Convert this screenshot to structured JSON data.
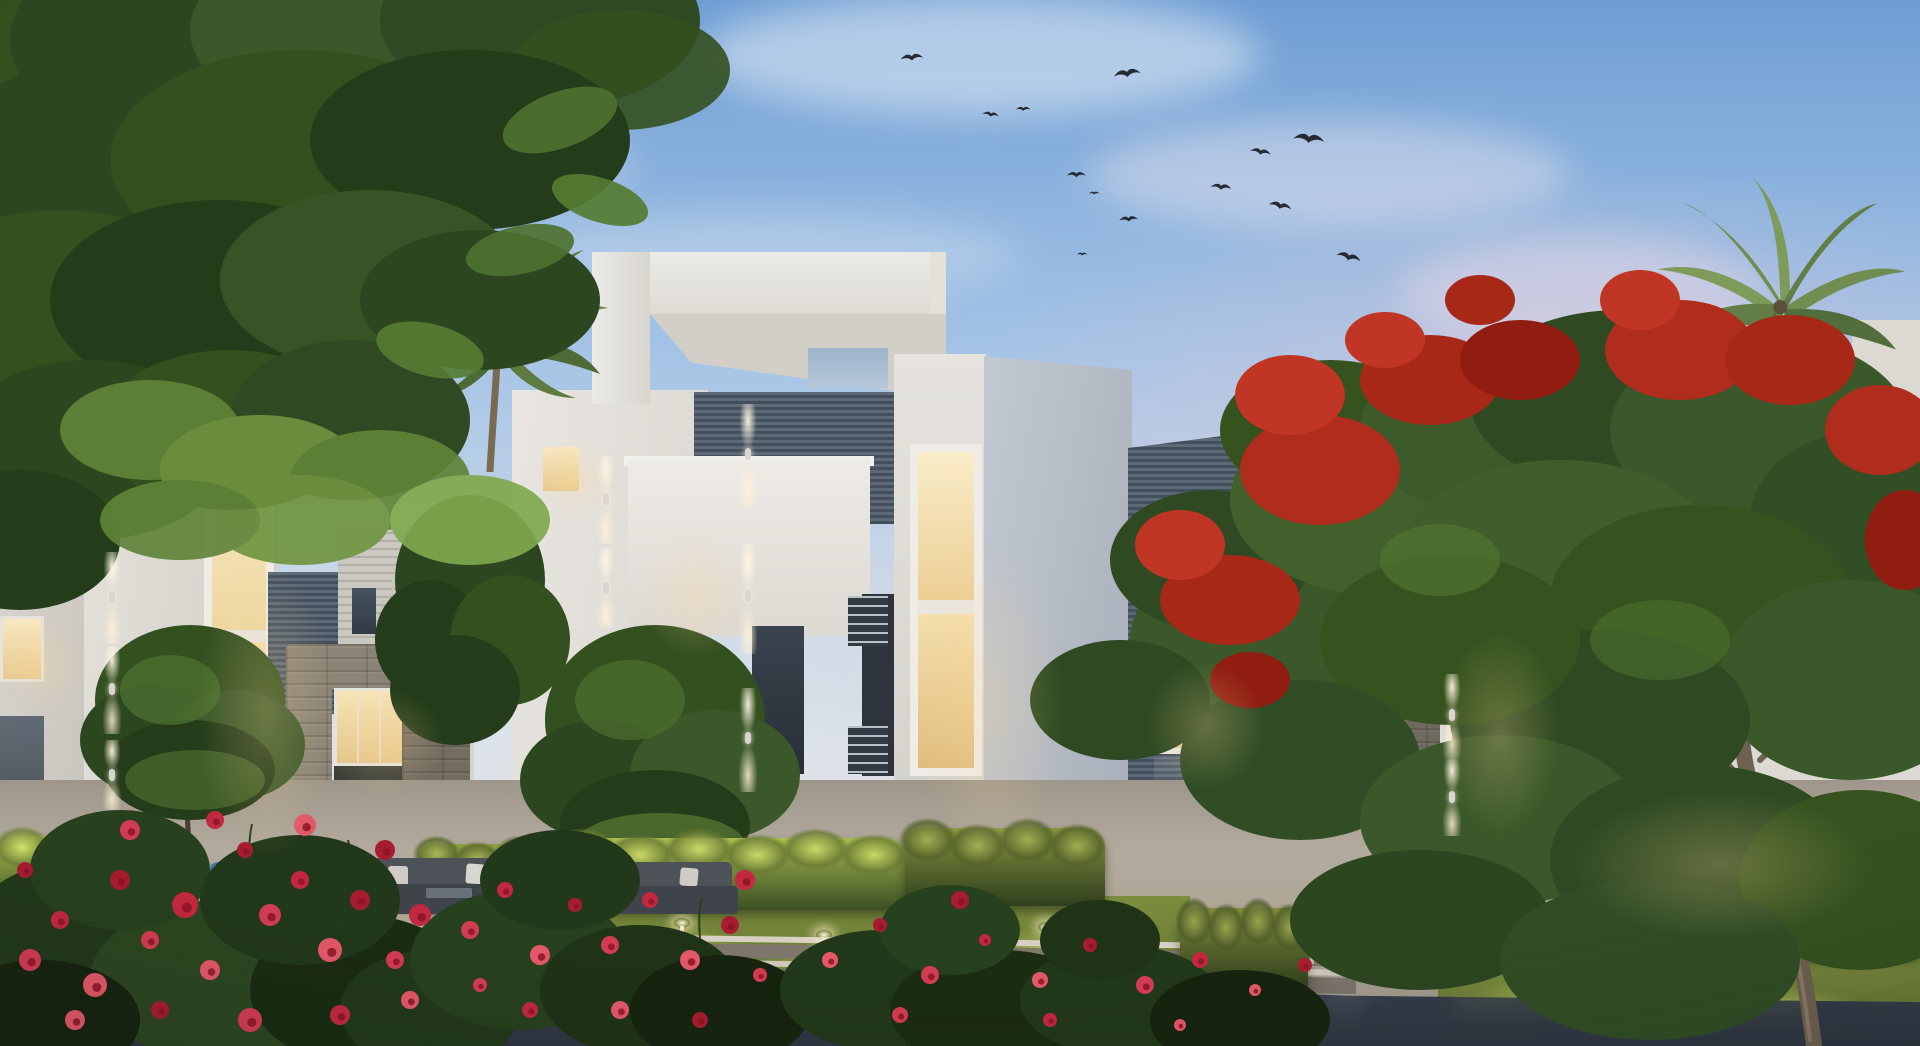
{
  "meta": {
    "scene": "Dusk architectural rendering — modern white residential villas with lit windows, palms, flame tree, rose beds, lit hedges and a reflective promenade",
    "width": 1920,
    "height": 1046,
    "time_of_day": "dusk",
    "visible_text": "none"
  },
  "palette": {
    "sky-top": "#6f9ed4",
    "sky-mid": "#a5c4e6",
    "sky-low": "#cfdbe9",
    "sky-pink": "#dec4d6",
    "cloud": "#eef3f8",
    "bird": "#262b33",
    "wall-white": "#e7e4df",
    "wall-shade": "#d2cfc9",
    "wall-blue": "#b7bdc7",
    "louver-light": "#5c6a78",
    "louver-dark": "#434f5c",
    "siding": "#c9c6c0",
    "siding-line": "#aeaba5",
    "stone": "#8b8476",
    "stone-dark": "#6e685c",
    "glow-warm": "#f5e2b4",
    "glow-deep": "#e9cf98",
    "hedge-lit": "#b9cb54",
    "hedge-dark": "#3f5226",
    "lawn": "#84953f",
    "lawn-lit": "#ccd76a",
    "foliage-dark": "#2c4620",
    "foliage-mid": "#33501f",
    "foliage-light": "#557c33",
    "palm-green": "#6f8c4c",
    "flame-red": "#b02c1c",
    "rose-red": "#d23c52",
    "pavement": "#aca394",
    "pavement-dark": "#8f887c",
    "water": "#3e4654",
    "trunk": "#5a4a34",
    "accent-chair": "#3f7fb5"
  },
  "sky": {
    "clouds": [
      {
        "x": 980,
        "y": 55,
        "w": 560,
        "h": 120,
        "o": 0.5,
        "c": "#eef3f8"
      },
      {
        "x": 420,
        "y": 165,
        "w": 420,
        "h": 95,
        "o": 0.38,
        "c": "#eef3f8"
      },
      {
        "x": 170,
        "y": 300,
        "w": 340,
        "h": 70,
        "o": 0.32,
        "c": "#e8eef5"
      },
      {
        "x": 1330,
        "y": 175,
        "w": 480,
        "h": 110,
        "o": 0.42,
        "c": "#f0e8ee"
      },
      {
        "x": 760,
        "y": 255,
        "w": 520,
        "h": 85,
        "o": 0.3,
        "c": "#eaf0f6"
      },
      {
        "x": 1580,
        "y": 295,
        "w": 360,
        "h": 120,
        "o": 0.45,
        "c": "#efe0e8"
      }
    ],
    "birds": [
      {
        "x": 900,
        "y": 54,
        "s": 1.1,
        "r": -5
      },
      {
        "x": 983,
        "y": 110,
        "s": 0.8,
        "r": 8
      },
      {
        "x": 1016,
        "y": 106,
        "s": 0.7,
        "r": 0
      },
      {
        "x": 1113,
        "y": 70,
        "s": 1.3,
        "r": -8
      },
      {
        "x": 1294,
        "y": 131,
        "s": 1.5,
        "r": 6
      },
      {
        "x": 1251,
        "y": 146,
        "s": 1.0,
        "r": 10
      },
      {
        "x": 1067,
        "y": 171,
        "s": 0.9,
        "r": 0
      },
      {
        "x": 1089,
        "y": 191,
        "s": 0.5,
        "r": 0
      },
      {
        "x": 1119,
        "y": 216,
        "s": 0.9,
        "r": -4
      },
      {
        "x": 1211,
        "y": 182,
        "s": 1.0,
        "r": 5
      },
      {
        "x": 1270,
        "y": 199,
        "s": 1.1,
        "r": 12
      },
      {
        "x": 1077,
        "y": 252,
        "s": 0.5,
        "r": 0
      },
      {
        "x": 1338,
        "y": 249,
        "s": 1.2,
        "r": 15
      }
    ]
  },
  "buildings": {
    "far_left_block": {
      "color": "white",
      "lit_windows": 1,
      "dim_windows": 1
    },
    "left_villa_a": {
      "features": [
        "tall warm-lit double niche",
        "up-down wall washer lights"
      ]
    },
    "left_villa_b": {
      "features": [
        "vertical louver panel",
        "horizontal siding box",
        "two dark windows",
        "stone portal with lit interior",
        "red bougainvillea on pier"
      ]
    },
    "center_villa": {
      "features": [
        "white roof pergola frame with skylight opening",
        "recessed dark louver band",
        "balcony volume",
        "stacked warm-lit window niches",
        "wall washer columns",
        "glass storefront",
        "balcony railings"
      ]
    },
    "louver_wall": {
      "features": [
        "steel horizontal louvers",
        "warm-lit window with plant",
        "glass entry door"
      ]
    },
    "right_villa": {
      "features": [
        "horizontal siding upper box",
        "large dark corner window",
        "stone string course",
        "stone pier",
        "vertical-slat lit windows",
        "balcony slat screen",
        "large lit living-room window",
        "stone wainscot"
      ]
    },
    "far_right_sliver": {
      "color": "white"
    }
  },
  "flora": {
    "trees": [
      "overhanging canopy top-left",
      "round ornamental tree x3",
      "fan palm x2",
      "royal poinciana (flame tree)"
    ],
    "rose_flowers": [
      {
        "x": 30,
        "y": 960,
        "r": 11
      },
      {
        "x": 60,
        "y": 920,
        "r": 9
      },
      {
        "x": 95,
        "y": 985,
        "r": 12
      },
      {
        "x": 120,
        "y": 880,
        "r": 10
      },
      {
        "x": 150,
        "y": 940,
        "r": 9
      },
      {
        "x": 185,
        "y": 905,
        "r": 13
      },
      {
        "x": 210,
        "y": 970,
        "r": 10
      },
      {
        "x": 245,
        "y": 850,
        "r": 8
      },
      {
        "x": 270,
        "y": 915,
        "r": 11
      },
      {
        "x": 300,
        "y": 880,
        "r": 9
      },
      {
        "x": 330,
        "y": 950,
        "r": 12
      },
      {
        "x": 360,
        "y": 900,
        "r": 10
      },
      {
        "x": 395,
        "y": 960,
        "r": 9
      },
      {
        "x": 420,
        "y": 915,
        "r": 11
      },
      {
        "x": 75,
        "y": 1020,
        "r": 10
      },
      {
        "x": 160,
        "y": 1010,
        "r": 9
      },
      {
        "x": 250,
        "y": 1020,
        "r": 12
      },
      {
        "x": 340,
        "y": 1015,
        "r": 10
      },
      {
        "x": 410,
        "y": 1000,
        "r": 9
      },
      {
        "x": 25,
        "y": 870,
        "r": 8
      },
      {
        "x": 130,
        "y": 830,
        "r": 10
      },
      {
        "x": 215,
        "y": 820,
        "r": 9
      },
      {
        "x": 305,
        "y": 825,
        "r": 11
      },
      {
        "x": 385,
        "y": 850,
        "r": 10
      },
      {
        "x": 470,
        "y": 930,
        "r": 9
      },
      {
        "x": 505,
        "y": 890,
        "r": 8
      },
      {
        "x": 540,
        "y": 955,
        "r": 10
      },
      {
        "x": 575,
        "y": 905,
        "r": 7
      },
      {
        "x": 610,
        "y": 945,
        "r": 9
      },
      {
        "x": 650,
        "y": 900,
        "r": 8
      },
      {
        "x": 690,
        "y": 960,
        "r": 10
      },
      {
        "x": 730,
        "y": 925,
        "r": 9
      },
      {
        "x": 760,
        "y": 975,
        "r": 7
      },
      {
        "x": 530,
        "y": 1010,
        "r": 8
      },
      {
        "x": 620,
        "y": 1010,
        "r": 9
      },
      {
        "x": 700,
        "y": 1020,
        "r": 8
      },
      {
        "x": 480,
        "y": 985,
        "r": 7
      },
      {
        "x": 745,
        "y": 880,
        "r": 10
      },
      {
        "x": 830,
        "y": 960,
        "r": 8
      },
      {
        "x": 880,
        "y": 925,
        "r": 7
      },
      {
        "x": 930,
        "y": 975,
        "r": 9
      },
      {
        "x": 985,
        "y": 940,
        "r": 6
      },
      {
        "x": 1040,
        "y": 980,
        "r": 8
      },
      {
        "x": 1090,
        "y": 945,
        "r": 7
      },
      {
        "x": 1145,
        "y": 985,
        "r": 9
      },
      {
        "x": 1200,
        "y": 960,
        "r": 8
      },
      {
        "x": 1255,
        "y": 990,
        "r": 6
      },
      {
        "x": 1305,
        "y": 965,
        "r": 7
      },
      {
        "x": 900,
        "y": 1015,
        "r": 8
      },
      {
        "x": 1050,
        "y": 1020,
        "r": 7
      },
      {
        "x": 1180,
        "y": 1025,
        "r": 6
      },
      {
        "x": 960,
        "y": 900,
        "r": 9
      }
    ]
  },
  "landscape": {
    "hedges": [
      {
        "x": 0,
        "y": 836,
        "w": 198,
        "h": 74,
        "b": 1.05
      },
      {
        "x": 418,
        "y": 844,
        "w": 164,
        "h": 64,
        "b": 0.85
      },
      {
        "x": 556,
        "y": 838,
        "w": 350,
        "h": 72,
        "b": 1.0
      },
      {
        "x": 905,
        "y": 828,
        "w": 200,
        "h": 78,
        "b": 0.8
      },
      {
        "x": 1180,
        "y": 908,
        "w": 128,
        "h": 84,
        "b": 0.75
      },
      {
        "x": 1658,
        "y": 848,
        "w": 262,
        "h": 108,
        "b": 0.9
      }
    ],
    "lawn_pools": [
      {
        "x": 660,
        "y": 952,
        "rx": 95,
        "ry": 26
      },
      {
        "x": 852,
        "y": 962,
        "rx": 90,
        "ry": 24
      },
      {
        "x": 1058,
        "y": 952,
        "rx": 85,
        "ry": 24
      },
      {
        "x": 1562,
        "y": 1000,
        "rx": 95,
        "ry": 26
      },
      {
        "x": 1775,
        "y": 1010,
        "rx": 90,
        "ry": 24
      },
      {
        "x": 62,
        "y": 928,
        "rx": 70,
        "ry": 20
      },
      {
        "x": 1242,
        "y": 962,
        "rx": 70,
        "ry": 22
      }
    ],
    "bollards": [
      {
        "x": 57,
        "y": 862,
        "h": 30
      },
      {
        "x": 120,
        "y": 856,
        "h": 26
      },
      {
        "x": 680,
        "y": 926,
        "h": 30
      },
      {
        "x": 822,
        "y": 938,
        "h": 30
      },
      {
        "x": 896,
        "y": 938,
        "h": 34
      },
      {
        "x": 934,
        "y": 928,
        "h": 26
      },
      {
        "x": 963,
        "y": 938,
        "h": 28
      },
      {
        "x": 1044,
        "y": 930,
        "h": 30
      },
      {
        "x": 1310,
        "y": 934,
        "h": 30
      },
      {
        "x": 1497,
        "y": 920,
        "h": 30
      },
      {
        "x": 1592,
        "y": 938,
        "h": 32
      },
      {
        "x": 1640,
        "y": 946,
        "h": 30
      }
    ],
    "wall_washers": [
      {
        "x": 748,
        "y": 404,
        "h": 104
      },
      {
        "x": 748,
        "y": 544,
        "h": 110
      },
      {
        "x": 748,
        "y": 688,
        "h": 104
      },
      {
        "x": 606,
        "y": 456,
        "h": 88
      },
      {
        "x": 606,
        "y": 548,
        "h": 80
      },
      {
        "x": 112,
        "y": 552,
        "h": 92
      },
      {
        "x": 112,
        "y": 646,
        "h": 88
      },
      {
        "x": 112,
        "y": 740,
        "h": 70
      },
      {
        "x": 1452,
        "y": 674,
        "h": 84
      },
      {
        "x": 1452,
        "y": 758,
        "h": 78
      }
    ],
    "window_halos": [
      {
        "x": 915,
        "y": 540,
        "w": 150,
        "h": 330
      },
      {
        "x": 196,
        "y": 560,
        "w": 140,
        "h": 300
      },
      {
        "x": 640,
        "y": 530,
        "w": 110,
        "h": 130
      },
      {
        "x": 1146,
        "y": 660,
        "w": 120,
        "h": 130
      },
      {
        "x": 1440,
        "y": 630,
        "w": 120,
        "h": 210
      },
      {
        "x": 1570,
        "y": 790,
        "w": 300,
        "h": 150
      },
      {
        "x": 325,
        "y": 688,
        "w": 120,
        "h": 110
      },
      {
        "x": 536,
        "y": 440,
        "w": 80,
        "h": 80
      },
      {
        "x": 0,
        "y": 610,
        "w": 90,
        "h": 110
      }
    ],
    "reflection_streaks": [
      {
        "x": 300,
        "w": 50,
        "c": "#7a8292",
        "o": 0.25
      },
      {
        "x": 620,
        "w": 90,
        "c": "#85934e",
        "o": 0.38
      },
      {
        "x": 700,
        "w": 40,
        "c": "#9aa85c",
        "o": 0.3
      },
      {
        "x": 845,
        "w": 70,
        "c": "#85934e",
        "o": 0.35
      },
      {
        "x": 1060,
        "w": 80,
        "c": "#8b9a52",
        "o": 0.35
      },
      {
        "x": 1240,
        "w": 50,
        "c": "#7a8292",
        "o": 0.28
      },
      {
        "x": 1500,
        "w": 90,
        "c": "#85934e",
        "o": 0.3
      },
      {
        "x": 1770,
        "w": 80,
        "c": "#8b9a52",
        "o": 0.3
      },
      {
        "x": 70,
        "w": 110,
        "c": "#5a3c46",
        "o": 0.3
      },
      {
        "x": 960,
        "w": 34,
        "c": "#a8b0bc",
        "o": 0.3
      },
      {
        "x": 1345,
        "w": 40,
        "c": "#9aa2ae",
        "o": 0.26
      }
    ],
    "furniture": {
      "outdoor_sofas": 2,
      "white_pillows": 5,
      "accent_chair_color": "#3f7fb5",
      "sun_loungers": 2
    }
  }
}
